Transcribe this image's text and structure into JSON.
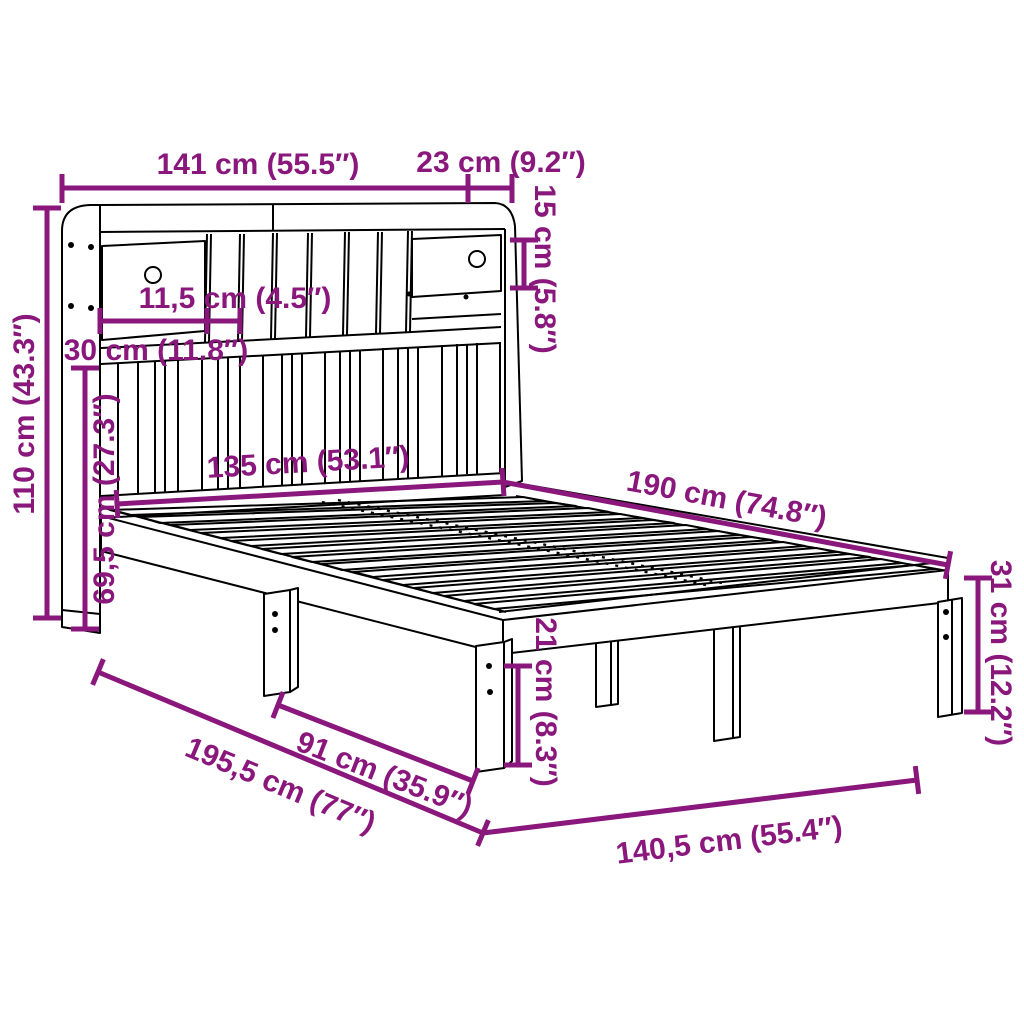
{
  "figure": {
    "kind": "furniture-dimension-diagram",
    "subject": "bookcase-bed-with-headboard-shelf"
  },
  "colors": {
    "accent": "#8a177c",
    "line": "#000000",
    "background": "#ffffff"
  },
  "dims": {
    "headboard_width": "141 cm (55.5″)",
    "headboard_top_depth": "23 cm (9.2″)",
    "top_shelf_height": "15 cm (5.8″)",
    "compartment_width": "11,5 cm (4.5″)",
    "drawer_section_width": "30 cm (11.8″)",
    "headboard_height": "110 cm (43.3″)",
    "headboard_lower_height": "69,5 cm (27.3″)",
    "bed_inner_width": "135 cm (53.1″)",
    "bed_inner_length": "190 cm (74.8″)",
    "foot_leg_height": "31 cm (12.2″)",
    "under_bed_clearance": "21 cm (8.3″)",
    "leg_spacing": "91 cm (35.9″)",
    "total_length": "195,5 cm (77″)",
    "total_width": "140,5 cm (55.4″)"
  }
}
